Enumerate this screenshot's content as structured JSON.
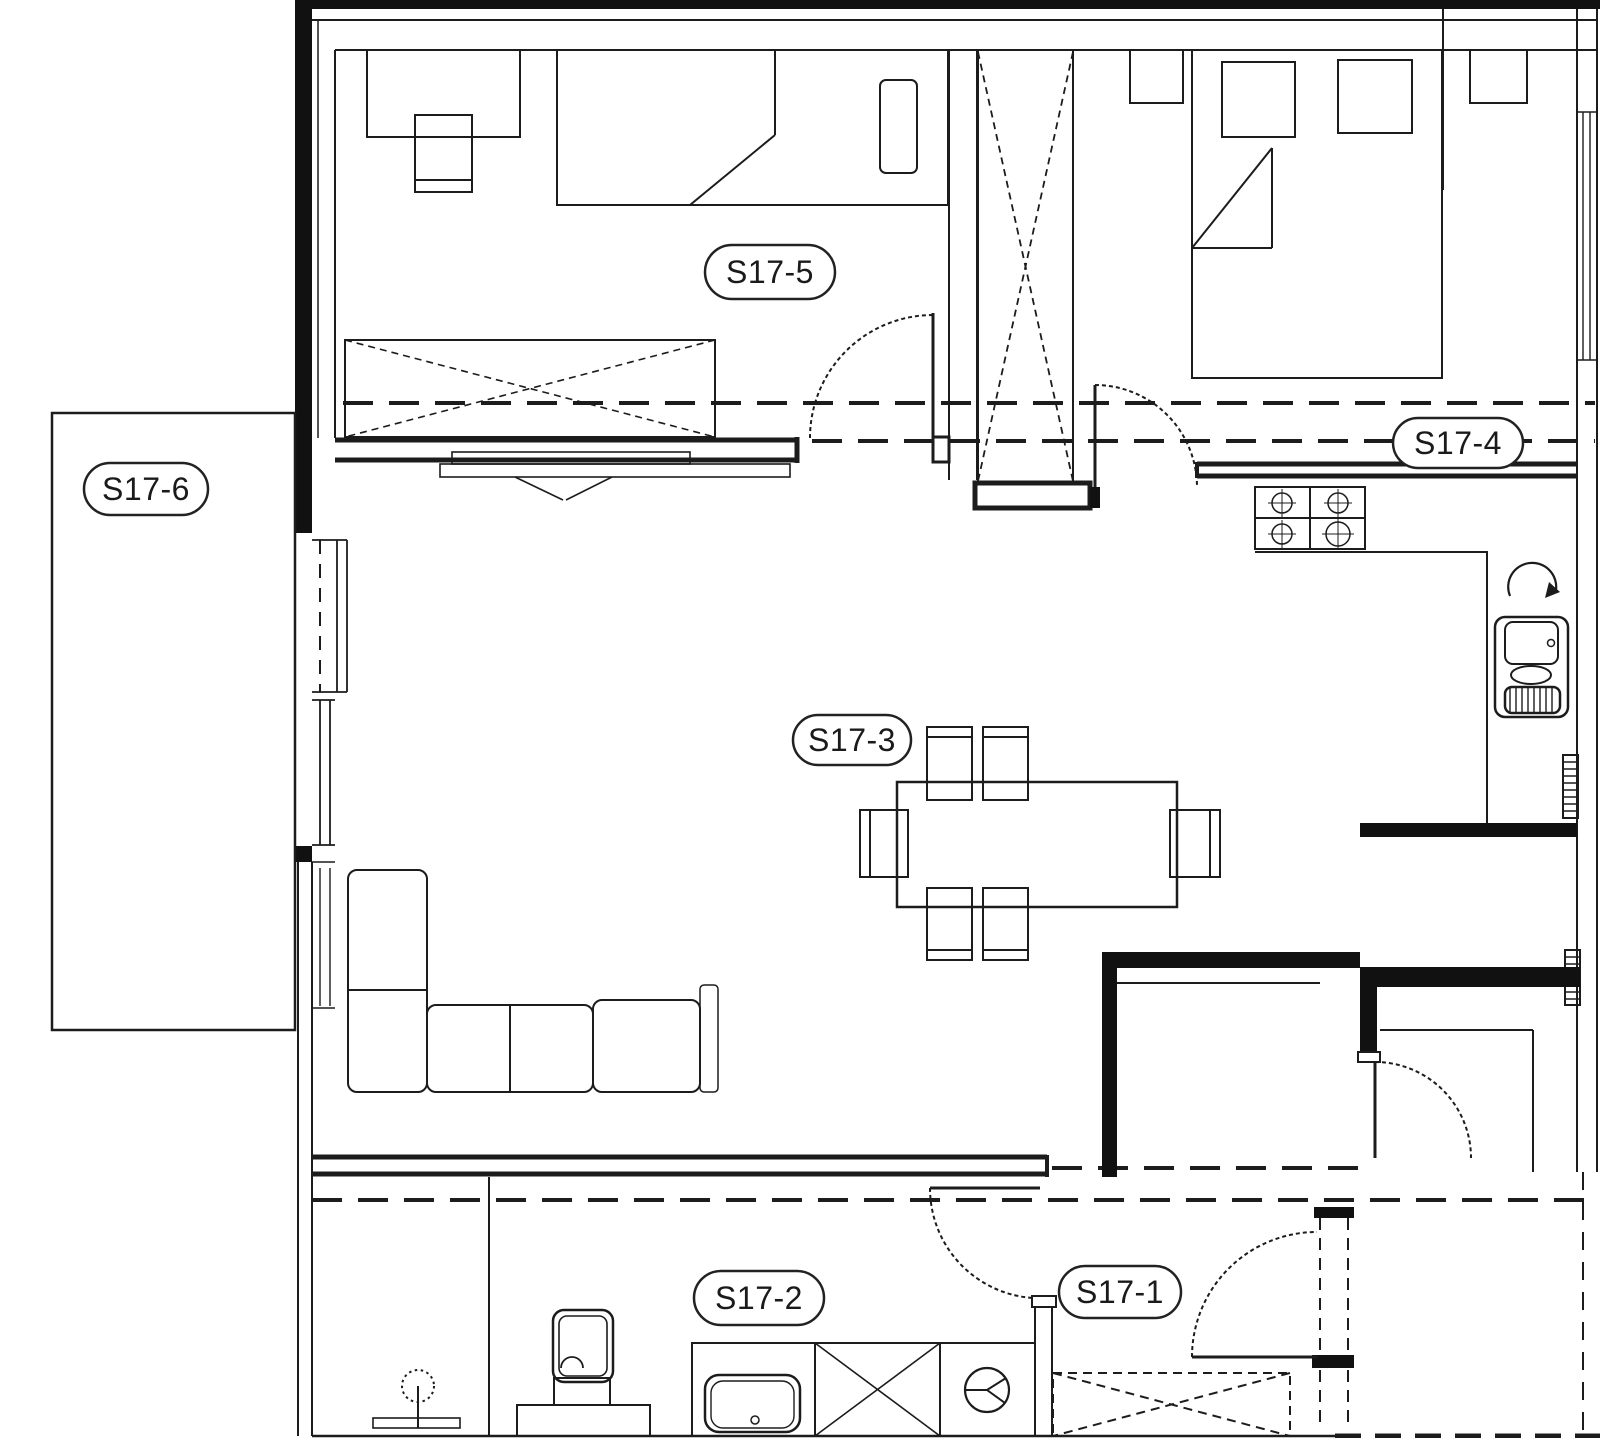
{
  "plan": {
    "rooms": [
      {
        "label": "S17-1"
      },
      {
        "label": "S17-2"
      },
      {
        "label": "S17-3"
      },
      {
        "label": "S17-4"
      },
      {
        "label": "S17-5"
      },
      {
        "label": "S17-6"
      }
    ],
    "colors": {
      "line": "#1c1c1c",
      "background": "#ffffff",
      "label_border": "#222222"
    }
  }
}
